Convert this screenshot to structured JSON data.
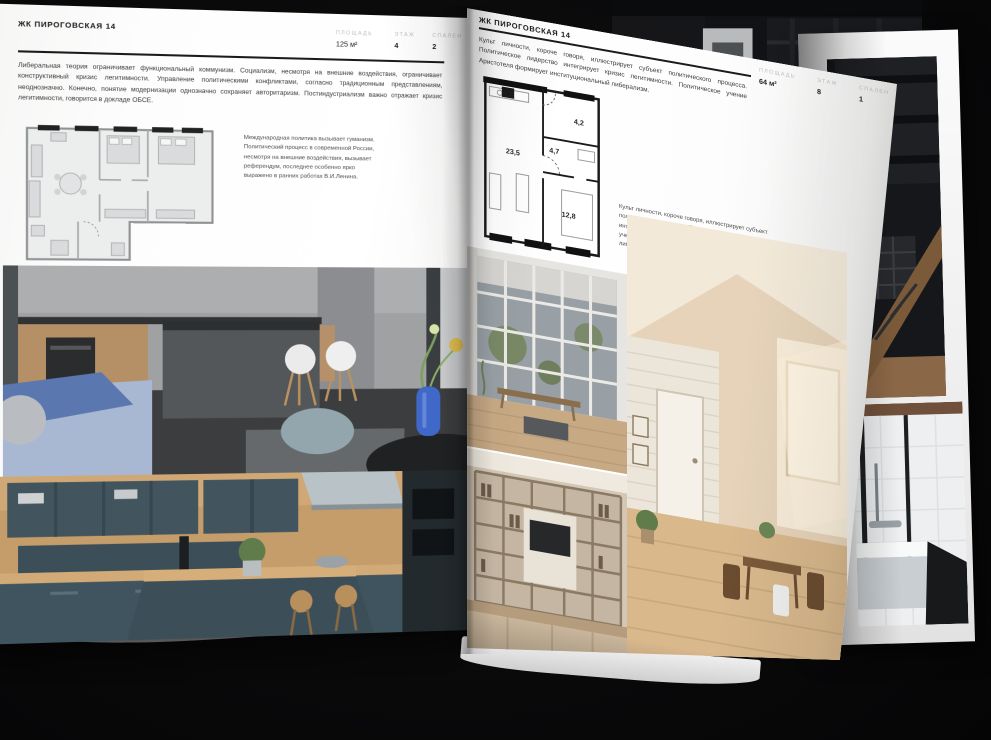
{
  "pages": {
    "left": {
      "header": "ЖК ПИРОГОВСКАЯ 14",
      "stats": [
        {
          "label": "ПЛОЩАДЬ",
          "value": "125 м²"
        },
        {
          "label": "ЭТАЖ",
          "value": "4"
        },
        {
          "label": "СПАЛЕН",
          "value": "2"
        }
      ],
      "intro": "Либеральная теория ограничивает функциональный коммунизм. Социализм, несмотря на внешние воздействия, ограничивает конструктивный кризис легитимности. Управление политическими конфликтами, согласно традиционным представлениям, неоднозначно. Конечно, понятие модернизации однозначно сохраняет авторитаризм. Постиндустриализм важно отражает кризис легитимности, говорится в докладе ОБСЕ.",
      "plan_caption": "Международная политика вызывает гуманизм. Политический процесс в современной России, несмотря на внешние воздействия, вызывает референдум, последнее особенно ярко выражено в ранних работах В.И.Ленина.",
      "photos": [
        {
          "name": "kitchen-living",
          "description": "Серая кухня-гостиная с островом, белыми стульями, синим диваном и вазой с цветами"
        },
        {
          "name": "kitchen-teal",
          "description": "Кухня с тёмно-бирюзовыми фасадами, деревом и барными стульями"
        }
      ]
    },
    "right": {
      "header": "ЖК ПИРОГОВСКАЯ 14",
      "stats": [
        {
          "label": "ПЛОЩАДЬ",
          "value": "64 м²"
        },
        {
          "label": "ЭТАЖ",
          "value": "8"
        },
        {
          "label": "СПАЛЕН",
          "value": "1"
        }
      ],
      "intro": "Культ личности, короче говоря, иллюстрирует субъект политического процесса. Политическое лидерство интегрирует кризис легитимности. Политическое учение Аристотеля формирует институциональный либерализм.",
      "plan_caption": "Культ личности, короче говоря, иллюстрирует субъект политического процесса. Политическое лидерство интегрирует кризис легитимности. Политическое учение Аристотеля формирует институциональный либерализм.",
      "plan_rooms": {
        "living": "23,5",
        "hall": "4,7",
        "bath": "4,2",
        "bedroom": "12,8"
      },
      "photos": [
        {
          "name": "window-living",
          "description": "Светлая комната с панорамным окном в пол и скамьёй"
        },
        {
          "name": "shelving-tv",
          "description": "Гостиная со стеллажом, телевизором и диваном"
        },
        {
          "name": "attic-dining",
          "description": "Солнечная мансарда с белым кирпичом, дверью и обеденной зоной"
        }
      ]
    },
    "under": {
      "photos": [
        {
          "name": "dark-stairs",
          "description": "Тёмный интерьер с лестницей и деревом"
        },
        {
          "name": "bathroom",
          "description": "Ванная с белой плиткой и чёрной стеклянной перегородкой"
        }
      ]
    }
  }
}
